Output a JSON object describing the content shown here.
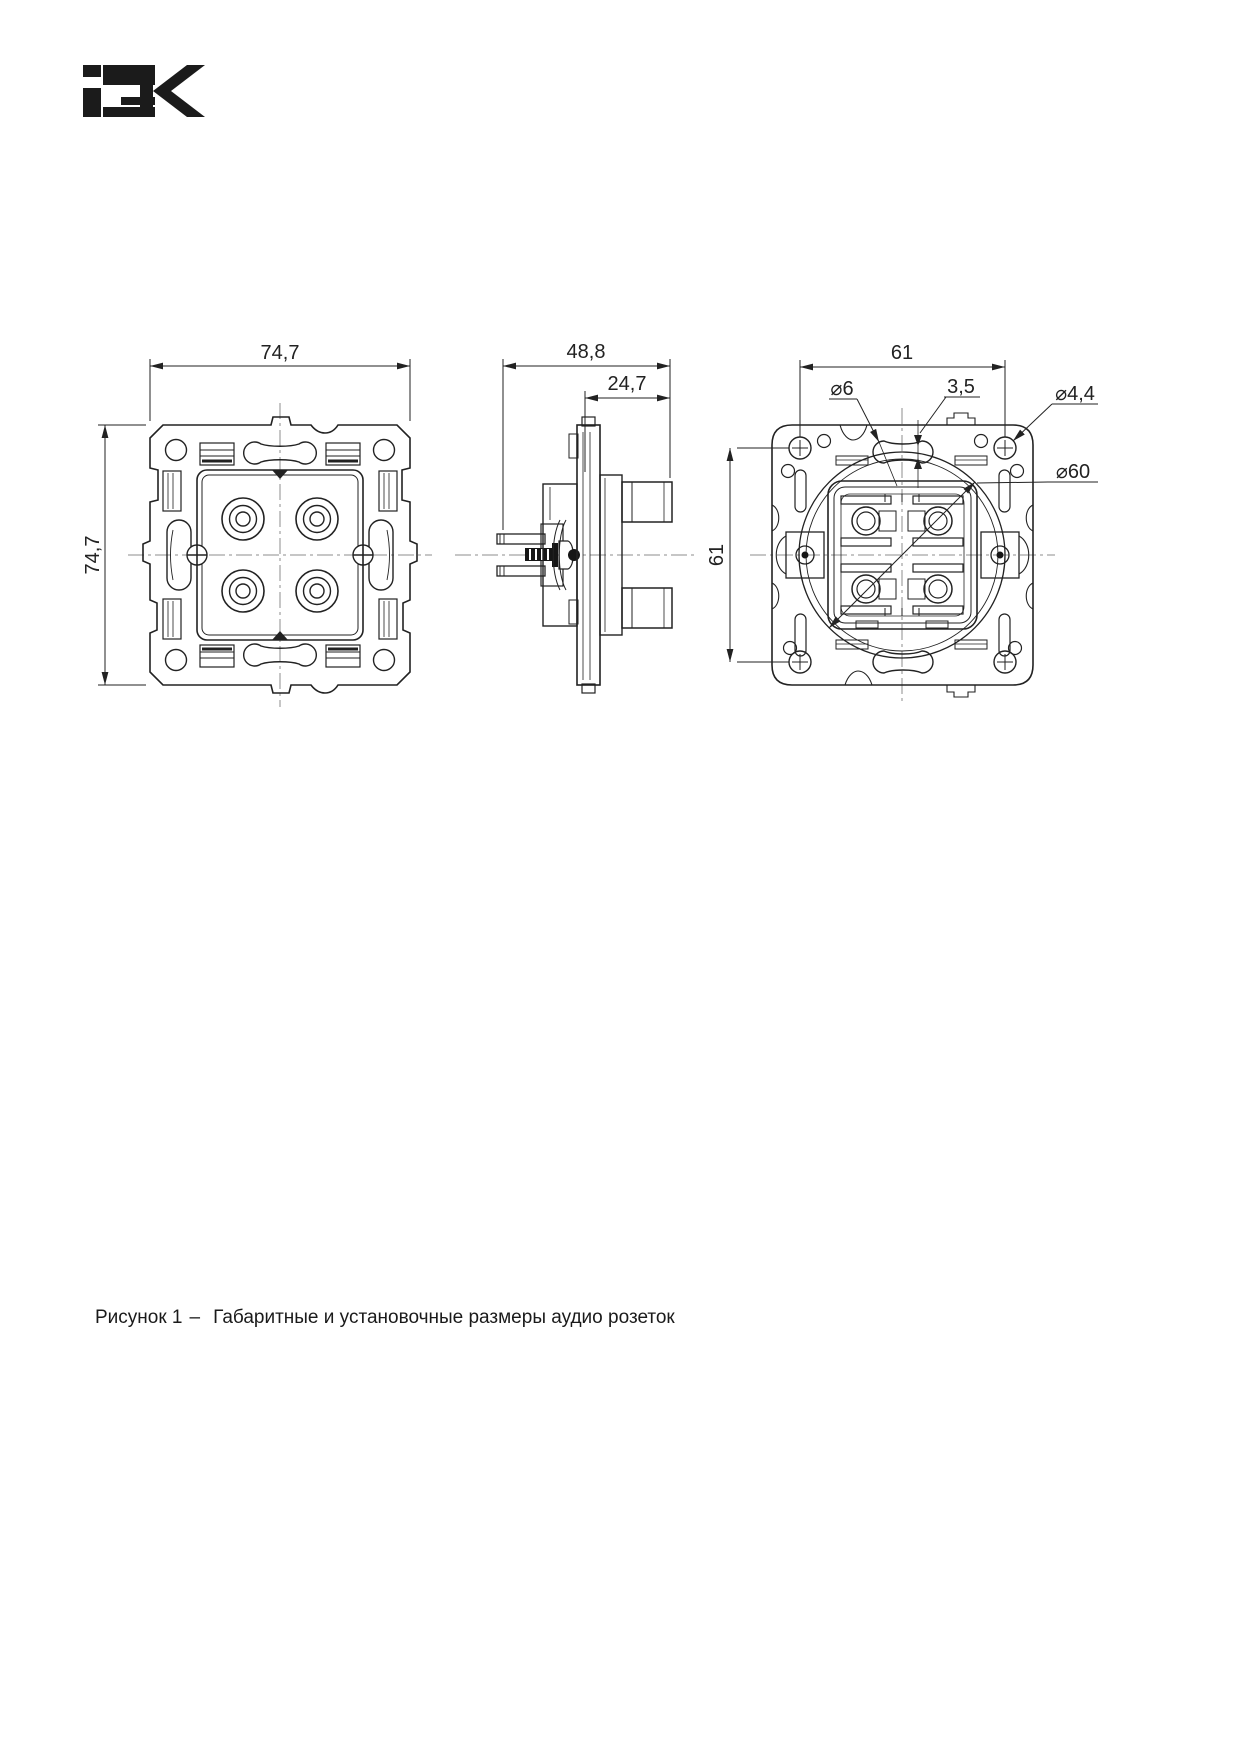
{
  "logo": {
    "name": "iek-logo",
    "alt": "IEK",
    "color": "#1b1b1b"
  },
  "figure_caption": {
    "label": "Рисунок 1",
    "separator": "–",
    "text": "Габаритные и установочные размеры аудио розеток"
  },
  "views": {
    "front": {
      "name": "front-view",
      "dimensions": {
        "width": "74,7",
        "height": "74,7"
      }
    },
    "side": {
      "name": "side-view",
      "dimensions": {
        "depth_total": "48,8",
        "depth_front": "24,7"
      }
    },
    "back": {
      "name": "back-view",
      "dimensions": {
        "mount_width": "61",
        "mount_height": "61",
        "slot_end_diameter": "⌀6",
        "slot_width": "3,5",
        "screw_hole_diameter": "⌀4,4",
        "support_ring_diameter": "⌀60"
      }
    }
  },
  "style": {
    "ink": "#222222",
    "centerline": "#8c8c8c",
    "background": "#ffffff"
  }
}
